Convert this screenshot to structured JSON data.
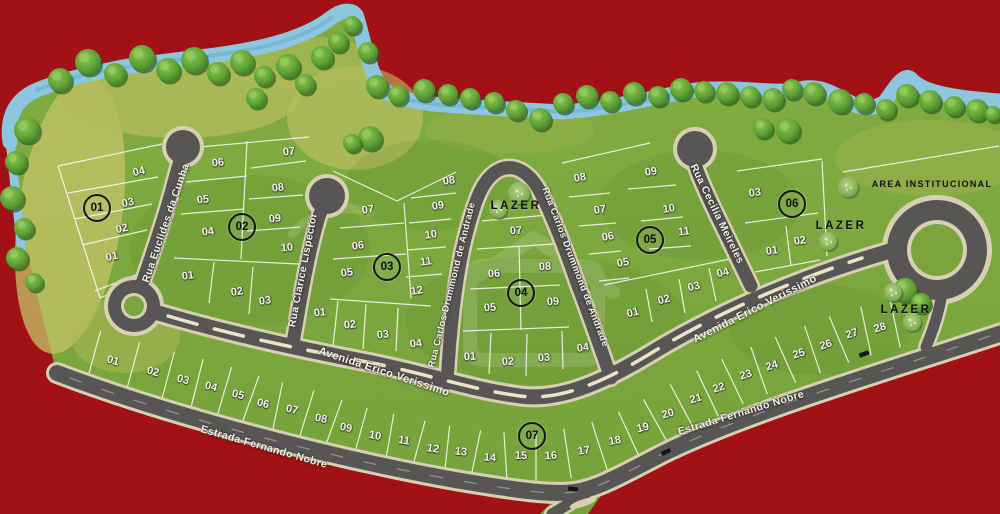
{
  "map": {
    "type": "residential subdivision site plan",
    "colors": {
      "background": "#a21116",
      "water": "#8cc7df",
      "grass": "#7aa53d",
      "grass_dry": "#c3c167",
      "road_asphalt": "#575655",
      "road_edge": "#d8d0b2",
      "lot_line": "#ffffff",
      "tree_green": "#4e8f2a",
      "street_text": "#f5f2e6",
      "area_text": "#101010"
    }
  },
  "streets": [
    "Rua Euclides da Cunha",
    "Rua Clarice Lispector",
    "Rua Carlos Drummond de Andrade",
    "Rua Cecilia Meireles",
    "Avenida Erico Verissimo",
    "Estrada Fernando Nobre"
  ],
  "areas": {
    "lazer": "LAZER",
    "institutional": "AREA INSTITUCIONAL"
  },
  "blocks": [
    {
      "id": "01",
      "lots": [
        "01",
        "02",
        "03",
        "04"
      ]
    },
    {
      "id": "02",
      "lots": [
        "01",
        "02",
        "03",
        "04",
        "05",
        "06",
        "07",
        "08",
        "09",
        "10"
      ]
    },
    {
      "id": "03",
      "lots": [
        "01",
        "02",
        "03",
        "04",
        "05",
        "06",
        "07",
        "08",
        "09",
        "10",
        "11",
        "12"
      ]
    },
    {
      "id": "04",
      "lots": [
        "01",
        "02",
        "03",
        "04",
        "05",
        "06",
        "07",
        "08",
        "09"
      ]
    },
    {
      "id": "05",
      "lots": [
        "01",
        "02",
        "03",
        "04",
        "05",
        "06",
        "07",
        "08",
        "09",
        "10",
        "11"
      ]
    },
    {
      "id": "06",
      "lots": [
        "01",
        "02",
        "03"
      ]
    },
    {
      "id": "07",
      "lots": [
        "01",
        "02",
        "03",
        "04",
        "05",
        "06",
        "07",
        "08",
        "09",
        "10",
        "11",
        "12",
        "13",
        "14",
        "15",
        "16",
        "17",
        "18",
        "19",
        "20",
        "21",
        "22",
        "23",
        "24",
        "25",
        "26",
        "27",
        "28"
      ]
    }
  ]
}
